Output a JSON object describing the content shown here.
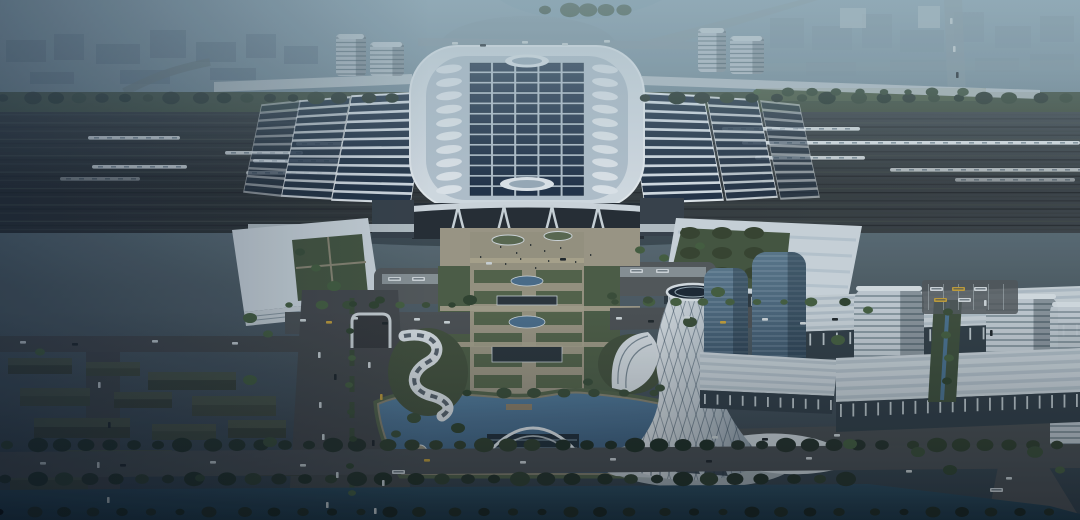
{
  "scene": {
    "palette": {
      "skyTop": "#8ba4b2",
      "skyMid": "#6d828c",
      "skyLow": "#515f66",
      "ground": "#3f4c54",
      "hazeCity": "#5e7285",
      "hazeCityRight": "#7b8f9c",
      "hazeWhite": "#b9c6cc",
      "railDark": "#2b2f31",
      "railLight": "#3e4549",
      "streaks": [
        "#23272a",
        "#3a4042",
        "#2c3133",
        "#454b49"
      ],
      "roofWhite": "#dce4ea",
      "roofDeck": "#b9c7d2",
      "roofEdge": "#eef3f6",
      "solarPanel": "#223349",
      "solarStripe": "#243447",
      "skylight": "#e8eef2",
      "facadeDark": "#262d34",
      "annex": "#39424a",
      "walkway": "#c6cfd4",
      "plazaTan": "#a29c88",
      "pathTan": "#9d9783",
      "lawn": "#56654a",
      "lawnDark": "#4f5f46",
      "grassBank": "#55644a",
      "mound": "#45523d",
      "road": "#4c5053",
      "roadDark": "#46494b",
      "dash": "#b9c1c4",
      "water": "#54799b",
      "waterDeep": "#3f5f7e",
      "canal": "#2d4c5f",
      "canalDeep": "#1d3645",
      "blockDark": "#3a4137",
      "blockTop": "#4e5748",
      "blockAlt": "#424a3d",
      "glassTower": "#5d7a8e",
      "glassTowerLow": "#3a5266",
      "bandTower": "#c7d0d6",
      "bandLine": "#5d7079",
      "towerWhite": "#e9edef",
      "towerShade": "#8e9ca7",
      "podiumRoof": "#ccd5da",
      "podiumFacade": "#333f47",
      "carWhite": "#d3dadc",
      "carDark": "#20262a",
      "taxi": "#c8a23a",
      "busWhite": "#d7dde0",
      "treeDark": "#27332a",
      "treeMid": "#3c4f38",
      "treeBlack": "#18231c"
    },
    "solarGrid": {
      "x": 470,
      "y": 63,
      "cols": 5,
      "rows": 13,
      "colPitch": 23.2,
      "rowPitch": 10.35,
      "pw": 20.8,
      "ph": 8.3
    },
    "skylights": {
      "count": 10,
      "y0": 69,
      "step": 13.4,
      "leftCx": 449,
      "rightCx": 605,
      "rx": 13,
      "ry": 4.2
    },
    "wingRoofs": [
      {
        "quad": [
          [
            352,
            96
          ],
          [
            428,
            92
          ],
          [
            410,
            203
          ],
          [
            332,
            200
          ]
        ],
        "n": 12,
        "o": 1
      },
      {
        "quad": [
          [
            300,
            101
          ],
          [
            350,
            97
          ],
          [
            331,
            199
          ],
          [
            282,
            196
          ]
        ],
        "n": 12,
        "o": 0.85
      },
      {
        "quad": [
          [
            262,
            105
          ],
          [
            300,
            101
          ],
          [
            281,
            196
          ],
          [
            244,
            192
          ]
        ],
        "n": 11,
        "o": 0.55
      },
      {
        "quad": [
          [
            627,
            92
          ],
          [
            703,
            96
          ],
          [
            723,
            200
          ],
          [
            645,
            203
          ]
        ],
        "n": 12,
        "o": 1
      },
      {
        "quad": [
          [
            707,
            97
          ],
          [
            757,
            100
          ],
          [
            777,
            197
          ],
          [
            727,
            200
          ]
        ],
        "n": 12,
        "o": 0.85
      },
      {
        "quad": [
          [
            761,
            101
          ],
          [
            799,
            105
          ],
          [
            819,
            197
          ],
          [
            781,
            199
          ]
        ],
        "n": 11,
        "o": 0.55
      }
    ],
    "trains": [
      {
        "x": 88,
        "y": 136,
        "w": 92,
        "o": 1
      },
      {
        "x": 296,
        "y": 142,
        "w": 186,
        "o": 1
      },
      {
        "x": 225,
        "y": 151,
        "w": 78,
        "o": 0.9
      },
      {
        "x": 253,
        "y": 159,
        "w": 193,
        "o": 1
      },
      {
        "x": 92,
        "y": 165,
        "w": 95,
        "o": 0.95
      },
      {
        "x": 246,
        "y": 171,
        "w": 205,
        "o": 0.7
      },
      {
        "x": 60,
        "y": 177,
        "w": 80,
        "o": 0.5
      },
      {
        "x": 722,
        "y": 127,
        "w": 138,
        "o": 0.95
      },
      {
        "x": 742,
        "y": 141,
        "w": 338,
        "o": 1
      },
      {
        "x": 755,
        "y": 156,
        "w": 110,
        "o": 0.9
      },
      {
        "x": 890,
        "y": 168,
        "w": 195,
        "o": 0.75
      },
      {
        "x": 955,
        "y": 178,
        "w": 120,
        "o": 0.55
      }
    ],
    "cityBlocks": [
      [
        6,
        40,
        40,
        22,
        0
      ],
      [
        54,
        34,
        30,
        26,
        0
      ],
      [
        96,
        44,
        44,
        20,
        0
      ],
      [
        150,
        30,
        36,
        28,
        0
      ],
      [
        196,
        42,
        40,
        20,
        0
      ],
      [
        246,
        34,
        30,
        24,
        0
      ],
      [
        284,
        46,
        34,
        18,
        0
      ],
      [
        120,
        70,
        50,
        14,
        0
      ],
      [
        30,
        72,
        44,
        12,
        0
      ],
      [
        210,
        68,
        46,
        12,
        0
      ],
      [
        770,
        18,
        34,
        30,
        1
      ],
      [
        812,
        26,
        40,
        24,
        1
      ],
      [
        862,
        14,
        30,
        34,
        1
      ],
      [
        900,
        30,
        44,
        22,
        1
      ],
      [
        954,
        12,
        30,
        30,
        1
      ],
      [
        995,
        26,
        36,
        22,
        1
      ],
      [
        1040,
        16,
        34,
        26,
        1
      ],
      [
        806,
        62,
        50,
        14,
        1
      ],
      [
        890,
        60,
        56,
        12,
        1
      ],
      [
        975,
        58,
        44,
        14,
        1
      ],
      [
        1030,
        54,
        44,
        16,
        1
      ],
      [
        840,
        8,
        26,
        20,
        2
      ],
      [
        918,
        6,
        22,
        22,
        2
      ]
    ],
    "residential": [
      [
        8,
        358,
        64,
        16
      ],
      [
        86,
        362,
        54,
        14
      ],
      [
        148,
        372,
        88,
        18
      ],
      [
        20,
        388,
        70,
        18
      ],
      [
        114,
        392,
        58,
        16
      ],
      [
        192,
        396,
        84,
        20
      ],
      [
        34,
        418,
        96,
        20
      ],
      [
        152,
        424,
        64,
        16
      ],
      [
        228,
        420,
        58,
        18
      ],
      [
        64,
        450,
        108,
        22
      ],
      [
        198,
        452,
        76,
        18
      ],
      [
        10,
        472,
        78,
        18
      ],
      [
        252,
        462,
        54,
        14
      ]
    ],
    "towers": [
      {
        "x": 336,
        "y": 34,
        "w": 30,
        "h": 42,
        "r": 4,
        "t": "band",
        "o": 0.85
      },
      {
        "x": 370,
        "y": 42,
        "w": 34,
        "h": 34,
        "r": 4,
        "t": "band",
        "o": 0.85
      },
      {
        "x": 698,
        "y": 28,
        "w": 28,
        "h": 44,
        "r": 4,
        "t": "band",
        "o": 0.85
      },
      {
        "x": 730,
        "y": 36,
        "w": 34,
        "h": 38,
        "r": 4,
        "t": "band",
        "o": 0.85
      },
      {
        "x": 704,
        "y": 268,
        "w": 44,
        "h": 104,
        "r": 12,
        "t": "glass",
        "o": 1
      },
      {
        "x": 752,
        "y": 252,
        "w": 54,
        "h": 130,
        "r": 14,
        "t": "glass",
        "o": 1
      },
      {
        "x": 854,
        "y": 286,
        "w": 70,
        "h": 126,
        "r": 16,
        "t": "band2",
        "o": 1
      },
      {
        "x": 986,
        "y": 294,
        "w": 72,
        "h": 116,
        "r": 16,
        "t": "band2",
        "o": 1
      },
      {
        "x": 1050,
        "y": 302,
        "w": 46,
        "h": 150,
        "r": 10,
        "t": "band2",
        "o": 0.95
      }
    ],
    "podiums": [
      {
        "roof": [
          [
            792,
            296
          ],
          [
            1080,
            286
          ],
          [
            1080,
            322
          ],
          [
            792,
            332
          ]
        ],
        "facade": [
          [
            792,
            332
          ],
          [
            1080,
            322
          ],
          [
            1080,
            350
          ],
          [
            792,
            360
          ]
        ],
        "ticks": {
          "x1": 796,
          "y1": 346,
          "x2": 1076,
          "y2": 336,
          "n": 22,
          "h": 12
        }
      },
      {
        "roof": [
          [
            700,
            352
          ],
          [
            838,
            360
          ],
          [
            834,
            396
          ],
          [
            700,
            390
          ]
        ],
        "facade": [
          [
            700,
            390
          ],
          [
            834,
            396
          ],
          [
            832,
            414
          ],
          [
            700,
            408
          ]
        ],
        "ticks": {
          "x1": 704,
          "y1": 404,
          "x2": 830,
          "y2": 410,
          "n": 11,
          "h": 10
        }
      },
      {
        "roof": [
          [
            836,
            358
          ],
          [
            1080,
            348
          ],
          [
            1080,
            392
          ],
          [
            836,
            402
          ]
        ],
        "facade": [
          [
            836,
            402
          ],
          [
            1080,
            392
          ],
          [
            1080,
            422
          ],
          [
            836,
            432
          ]
        ],
        "ticks": {
          "x1": 840,
          "y1": 417,
          "x2": 1076,
          "y2": 407,
          "n": 20,
          "h": 13
        }
      }
    ],
    "parterres": {
      "x": 474,
      "y0": 270,
      "rows": 6,
      "pitch": 21,
      "w": 108,
      "h": 13,
      "gapX": 522,
      "gapW": 14
    },
    "ponds": [
      {
        "cx": 527,
        "cy": 281,
        "rx": 16,
        "ry": 5
      },
      {
        "cx": 527,
        "cy": 322,
        "rx": 18,
        "ry": 6
      }
    ],
    "pavilions": [
      {
        "x": 497,
        "y": 296,
        "w": 60,
        "h": 9
      },
      {
        "x": 492,
        "y": 346,
        "w": 70,
        "h": 16
      }
    ],
    "treeRows": [
      {
        "x1": 6,
        "y": 100,
        "x2": 404,
        "step": 24,
        "r": 7,
        "s": "d"
      },
      {
        "x1": 648,
        "y": 100,
        "x2": 1072,
        "step": 26,
        "r": 7,
        "s": "d"
      },
      {
        "x1": 292,
        "y": 307,
        "x2": 464,
        "step": 27,
        "r": 5,
        "s": "m"
      },
      {
        "x1": 618,
        "y": 304,
        "x2": 854,
        "step": 28,
        "r": 5,
        "s": "m"
      },
      {
        "x1": 10,
        "y": 447,
        "x2": 1074,
        "step": 25,
        "r": 8,
        "s": "d"
      },
      {
        "x1": 8,
        "y": 481,
        "x2": 862,
        "step": 27,
        "r": 8,
        "s": "d"
      },
      {
        "x1": 2,
        "y": 514,
        "x2": 1078,
        "step": 30,
        "r": 6,
        "s": "x"
      },
      {
        "x1": 470,
        "y": 395,
        "x2": 656,
        "step": 31,
        "r": 6,
        "s": "m"
      },
      {
        "x1": 760,
        "y": 94,
        "x2": 982,
        "step": 25,
        "r": 5,
        "s": "m"
      },
      {
        "x1": 548,
        "y": 12,
        "x2": 642,
        "step": 19,
        "r": 8,
        "s": "m"
      }
    ],
    "treeCols": [
      {
        "x": 948,
        "y1": 312,
        "y2": 400,
        "step": 23,
        "r": 5,
        "s": "m"
      },
      {
        "x": 351,
        "y1": 304,
        "y2": 510,
        "step": 27,
        "r": 4,
        "s": "m"
      }
    ],
    "treeSingles": [
      [
        380,
        300
      ],
      [
        470,
        300
      ],
      [
        612,
        296
      ],
      [
        718,
        292
      ],
      [
        250,
        318
      ],
      [
        268,
        334
      ],
      [
        868,
        310
      ],
      [
        838,
        340
      ],
      [
        414,
        418
      ],
      [
        396,
        434
      ],
      [
        458,
        428
      ],
      [
        588,
        382
      ],
      [
        660,
        388
      ],
      [
        250,
        380
      ],
      [
        270,
        442
      ],
      [
        200,
        478
      ],
      [
        40,
        352
      ],
      [
        648,
        300
      ],
      [
        690,
        322
      ],
      [
        850,
        444
      ],
      [
        918,
        452
      ],
      [
        950,
        470
      ],
      [
        1035,
        452
      ],
      [
        1060,
        470
      ],
      [
        640,
        250
      ],
      [
        664,
        258
      ],
      [
        700,
        246
      ],
      [
        300,
        252
      ],
      [
        316,
        268
      ],
      [
        334,
        286
      ]
    ],
    "cars": [
      {
        "x": 300,
        "y": 319,
        "c": "w"
      },
      {
        "x": 326,
        "y": 321,
        "c": "y"
      },
      {
        "x": 352,
        "y": 317,
        "c": "w"
      },
      {
        "x": 382,
        "y": 322,
        "c": "d"
      },
      {
        "x": 414,
        "y": 318,
        "c": "w"
      },
      {
        "x": 444,
        "y": 321,
        "c": "w"
      },
      {
        "x": 616,
        "y": 317,
        "c": "w"
      },
      {
        "x": 648,
        "y": 320,
        "c": "d"
      },
      {
        "x": 684,
        "y": 316,
        "c": "w"
      },
      {
        "x": 720,
        "y": 321,
        "c": "y"
      },
      {
        "x": 762,
        "y": 318,
        "c": "w"
      },
      {
        "x": 800,
        "y": 322,
        "c": "w"
      },
      {
        "x": 832,
        "y": 318,
        "c": "d"
      },
      {
        "x": 318,
        "y": 352,
        "c": "w",
        "v": 1
      },
      {
        "x": 334,
        "y": 374,
        "c": "d",
        "v": 1
      },
      {
        "x": 319,
        "y": 402,
        "c": "w",
        "v": 1
      },
      {
        "x": 368,
        "y": 362,
        "c": "w",
        "v": 1
      },
      {
        "x": 380,
        "y": 394,
        "c": "y",
        "v": 1
      },
      {
        "x": 322,
        "y": 434,
        "c": "w",
        "v": 1
      },
      {
        "x": 372,
        "y": 440,
        "c": "d",
        "v": 1
      },
      {
        "x": 336,
        "y": 472,
        "c": "w",
        "v": 1
      },
      {
        "x": 382,
        "y": 480,
        "c": "w",
        "v": 1
      },
      {
        "x": 326,
        "y": 502,
        "c": "w",
        "v": 1
      },
      {
        "x": 374,
        "y": 508,
        "c": "w",
        "v": 1
      },
      {
        "x": 40,
        "y": 462,
        "c": "w"
      },
      {
        "x": 120,
        "y": 464,
        "c": "d"
      },
      {
        "x": 210,
        "y": 461,
        "c": "w"
      },
      {
        "x": 300,
        "y": 464,
        "c": "w"
      },
      {
        "x": 424,
        "y": 459,
        "c": "y"
      },
      {
        "x": 520,
        "y": 461,
        "c": "w"
      },
      {
        "x": 610,
        "y": 458,
        "c": "w"
      },
      {
        "x": 706,
        "y": 460,
        "c": "d"
      },
      {
        "x": 806,
        "y": 457,
        "c": "w"
      },
      {
        "x": 906,
        "y": 470,
        "c": "w"
      },
      {
        "x": 1006,
        "y": 477,
        "c": "w"
      },
      {
        "x": 20,
        "y": 341,
        "c": "w"
      },
      {
        "x": 72,
        "y": 343,
        "c": "d"
      },
      {
        "x": 152,
        "y": 340,
        "c": "w"
      },
      {
        "x": 232,
        "y": 342,
        "c": "w"
      },
      {
        "x": 98,
        "y": 382,
        "c": "w",
        "v": 1
      },
      {
        "x": 108,
        "y": 422,
        "c": "d",
        "v": 1
      },
      {
        "x": 97,
        "y": 462,
        "c": "w",
        "v": 1
      },
      {
        "x": 107,
        "y": 497,
        "c": "w",
        "v": 1
      },
      {
        "x": 712,
        "y": 436,
        "c": "w"
      },
      {
        "x": 762,
        "y": 438,
        "c": "d"
      },
      {
        "x": 834,
        "y": 434,
        "c": "w"
      },
      {
        "x": 984,
        "y": 300,
        "c": "w",
        "v": 1
      },
      {
        "x": 990,
        "y": 330,
        "c": "d",
        "v": 1
      },
      {
        "x": 452,
        "y": 42,
        "c": "w"
      },
      {
        "x": 480,
        "y": 44,
        "c": "d"
      },
      {
        "x": 522,
        "y": 41,
        "c": "w"
      },
      {
        "x": 562,
        "y": 43,
        "c": "w"
      },
      {
        "x": 604,
        "y": 40,
        "c": "w"
      },
      {
        "x": 950,
        "y": 18,
        "c": "w",
        "v": 1
      },
      {
        "x": 953,
        "y": 46,
        "c": "w",
        "v": 1
      },
      {
        "x": 956,
        "y": 72,
        "c": "d",
        "v": 1
      },
      {
        "x": 486,
        "y": 262,
        "c": "w"
      },
      {
        "x": 560,
        "y": 258,
        "c": "d"
      }
    ],
    "buses": [
      {
        "x": 388,
        "y": 277
      },
      {
        "x": 412,
        "y": 277
      },
      {
        "x": 630,
        "y": 269
      },
      {
        "x": 656,
        "y": 269
      },
      {
        "x": 930,
        "y": 287
      },
      {
        "x": 952,
        "y": 287,
        "c": "y"
      },
      {
        "x": 974,
        "y": 287
      },
      {
        "x": 934,
        "y": 298,
        "c": "y"
      },
      {
        "x": 958,
        "y": 298
      },
      {
        "x": 392,
        "y": 470
      },
      {
        "x": 990,
        "y": 488
      }
    ],
    "people": [
      [
        500,
        246
      ],
      [
        516,
        252
      ],
      [
        530,
        244
      ],
      [
        544,
        250
      ],
      [
        560,
        247
      ],
      [
        480,
        256
      ],
      [
        590,
        254
      ],
      [
        520,
        258
      ],
      [
        548,
        260
      ],
      [
        505,
        263
      ],
      [
        575,
        261
      ],
      [
        535,
        267
      ]
    ],
    "courtyardTrees": {
      "x0": 690,
      "y0": 233,
      "cols": 3,
      "rows": 3,
      "dx": 32,
      "dy": 20
    }
  }
}
